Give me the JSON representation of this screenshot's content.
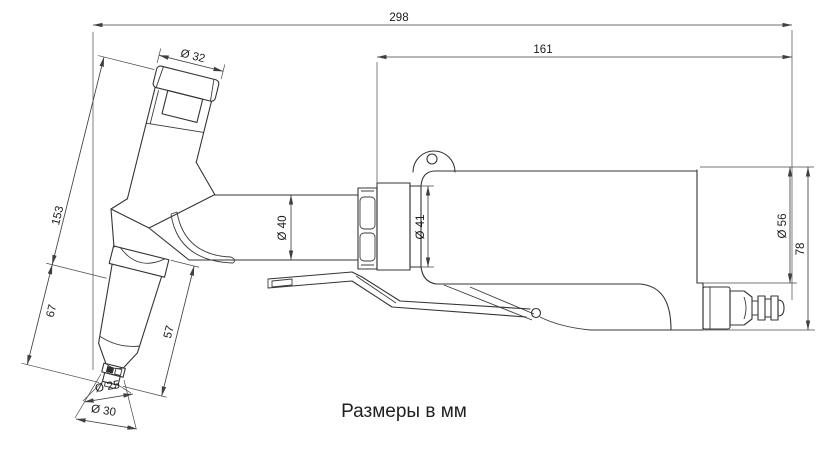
{
  "caption": "Размеры в мм",
  "dimensions": {
    "overall_length": "298",
    "motor_body_length": "161",
    "cap_diameter": "Ø 32",
    "handle_length": "153",
    "head_length": "67",
    "collet_length": "57",
    "tip_diameter": "Ø 25",
    "nozzle_diameter": "Ø 30",
    "neck_diameter": "Ø 40",
    "collar_diameter": "Ø 41",
    "body_diameter": "Ø 56",
    "rear_height": "78"
  },
  "colors": {
    "line": "#343434",
    "dimension_line": "#3f3f3f",
    "text": "#1c1c1c",
    "background": "#ffffff"
  }
}
